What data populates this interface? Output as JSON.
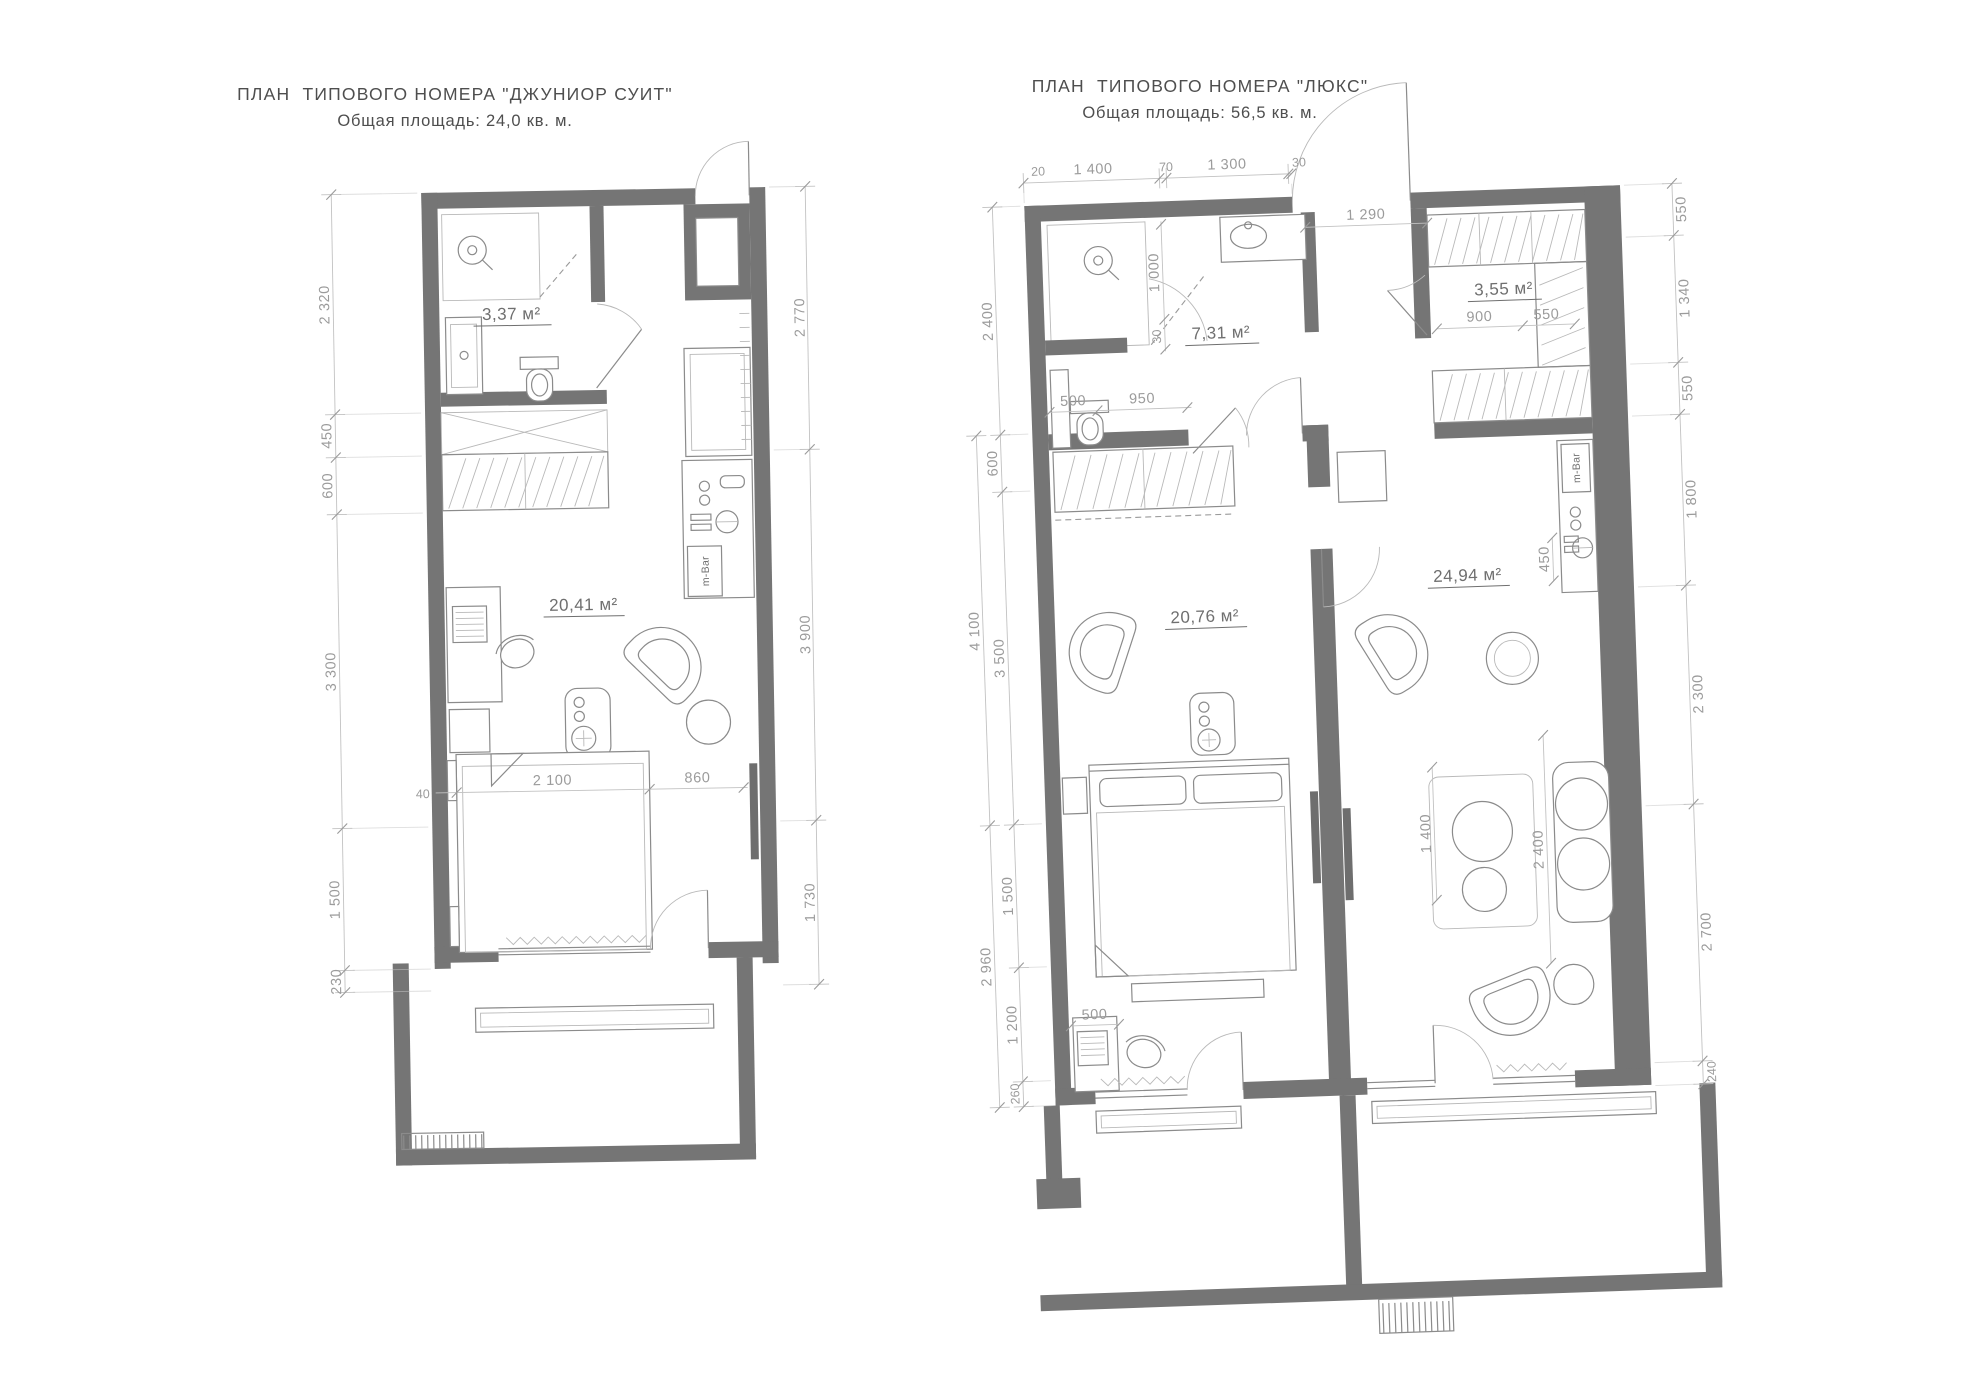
{
  "colors": {
    "wall": "#757575",
    "furniture_line": "#8b8b8b",
    "dim_text": "#9b9b9b",
    "title_text": "#4e4e4e"
  },
  "junior": {
    "title": "ПЛАН  ТИПОВОГО НОМЕРА \"ДЖУНИОР СУИТ\"",
    "subtitle": "Общая площадь: 24,0 кв. м.",
    "areas": {
      "bathroom": "3,37 м²",
      "room": "20,41 м²"
    },
    "minibar": "m-Bar",
    "dims_left": [
      "2 320",
      "450",
      "600",
      "3 300",
      "1 500",
      "230"
    ],
    "dims_right": [
      "2 770",
      "3 900",
      "1 730"
    ],
    "dims_inner": [
      "40",
      "2 100",
      "860"
    ]
  },
  "lux": {
    "title": "ПЛАН  ТИПОВОГО НОМЕРА \"ЛЮКС\"",
    "subtitle": "Общая площадь: 56,5 кв. м.",
    "areas": {
      "bathroom": "7,31 м²",
      "wardrobe": "3,55 м²",
      "bedroom": "20,76 м²",
      "living": "24,94 м²"
    },
    "minibar": "m-Bar",
    "dims_top": [
      "20",
      "1 400",
      "70",
      "1 300",
      "30"
    ],
    "dims_entry": [
      "1 290"
    ],
    "dims_left": [
      "2 400",
      "600",
      "3 500",
      "1 500",
      "1 200",
      "260"
    ],
    "dims_left_outer": [
      "4 100",
      "2 960"
    ],
    "dims_right": [
      "550",
      "1 340",
      "550",
      "1 800",
      "2 300",
      "2 700",
      "240"
    ],
    "dims_bath": [
      "1 000",
      "30",
      "500",
      "950"
    ],
    "dims_wardrobe": [
      "900",
      "550"
    ],
    "dims_living": [
      "450",
      "1 400",
      "2 400"
    ],
    "dims_bedroom": [
      "500"
    ]
  }
}
